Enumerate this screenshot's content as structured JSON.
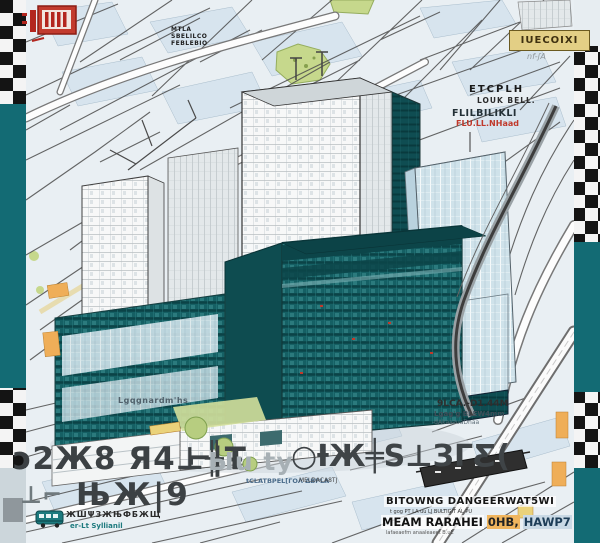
{
  "colors": {
    "border_teal": "#136b74",
    "building_teal": "#156064",
    "building_teal_dark": "#0f4d52",
    "glass_blue": "#cfe2ea",
    "map_bg": "#e9eff3",
    "block_blue": "#d7e4ee",
    "park_green": "#c6d88c",
    "accent_orange": "#efae58",
    "stamp_red": "#b3261e",
    "label_yellow": "#e3cf85",
    "caption_dark": "#3c4144",
    "caption_light": "#a7b0b5"
  },
  "labels": {
    "top_left_block": "MTLA\nSBELILCO\nFEBLEBIO",
    "top_right_tag": "IUECOIXI",
    "top_right_scribble": "nf-ʃA",
    "etcplh": "ETCPLH",
    "louk_bell": "LOUK BELL.",
    "flil": "FLILBILIKLI",
    "flil_red": "FLU.LL.NHaad",
    "left_mid": "Lgqgnardm'hs",
    "right_mid_1": "9LCA.-D1.44M",
    "right_mid_2": "Lgag'g BLEW4mm",
    "right_mid_3": "-dAkaaƨuaDnaa",
    "caption_row1_a": "ɔ2Ж8 Я4⊥╫Ŧ",
    "caption_row1_b": "⌐|",
    "caption_row1_c": "Ыu ty",
    "caption_row1_d": "○ƗЖ╪S⊥ЗГƸ(",
    "caption_row2_a": "⊥⌐",
    "caption_row2_b": "ЊЖ|9",
    "caption_sub": "tCLATBPEL[ΓΟΛ ΔΒΡLA",
    "bus_row_1": "ЖШΨЗЖЊФБЖЩ",
    "bus_row_2": "er-Lt Syllianil",
    "bottom_mid_tiny": "MELDACA8TJ",
    "bottom_right_1": "BITOWNG DANGEERWAT5WI",
    "bottom_right_1_sub": "t gog PT LA uu LJ BULTIGIT AL PU",
    "bottom_right_2a": "MEAM RARAHEI",
    "bottom_right_2b": "0HB,",
    "bottom_right_2c": "HAWP7",
    "bottom_right_2_sub": "lafaeaefm anaaleaeet B.uE"
  }
}
